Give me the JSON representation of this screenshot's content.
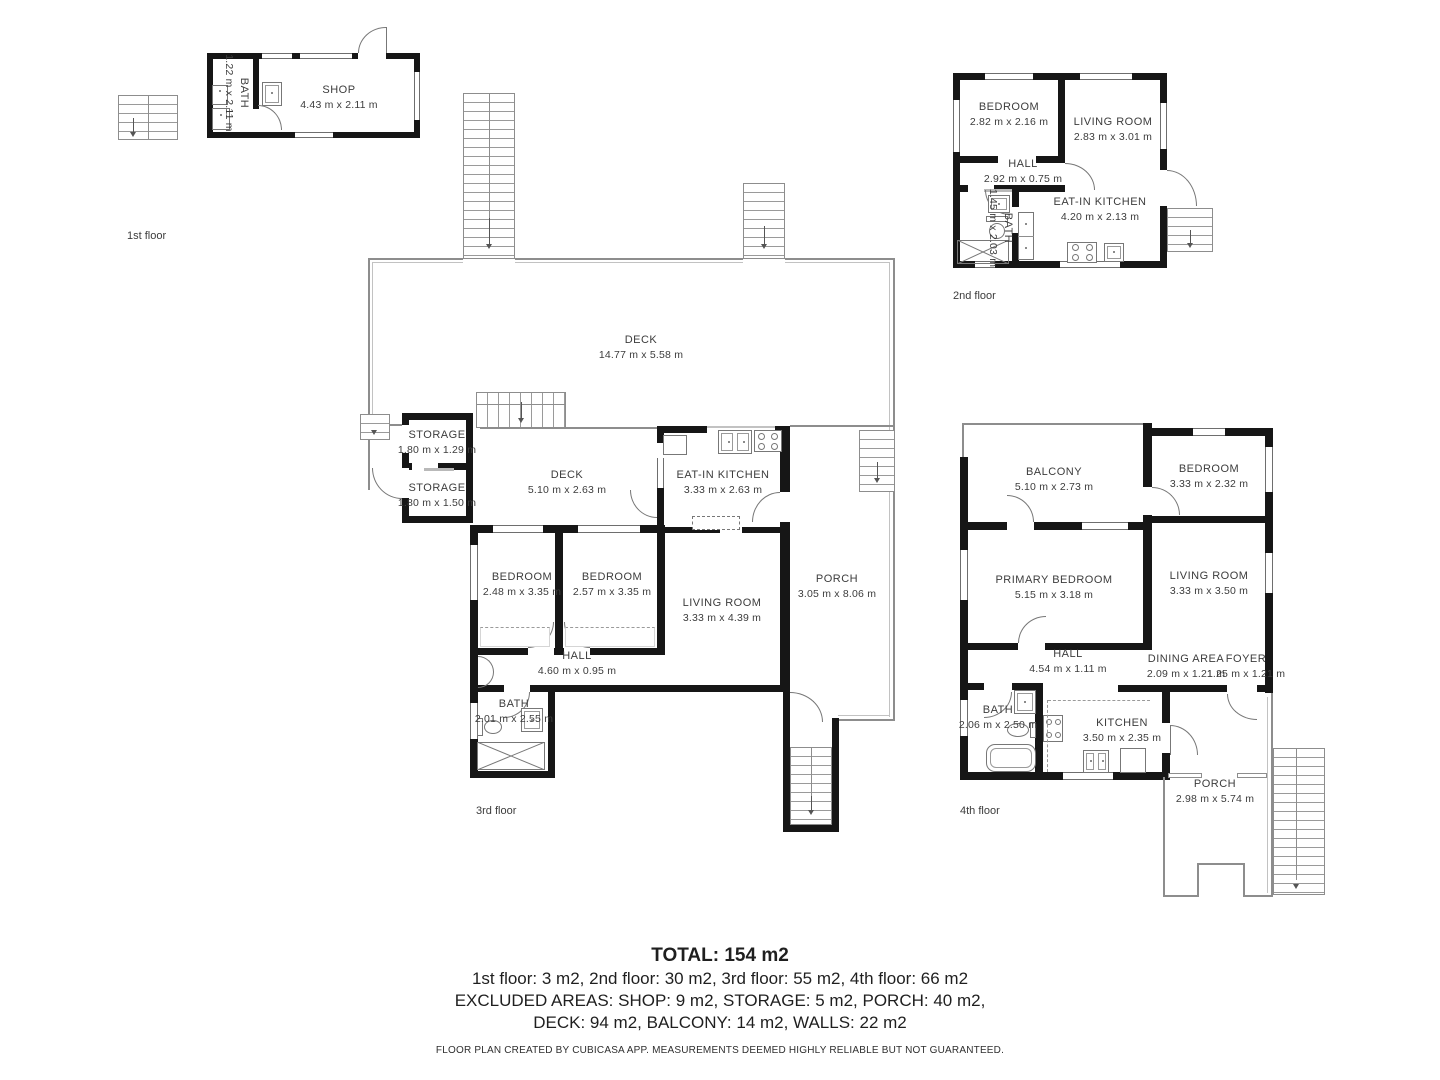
{
  "floors": {
    "f1": {
      "label": "1st floor",
      "rooms": {
        "bath": {
          "name": "BATH",
          "dims": "1.22 m x 2.11 m"
        },
        "shop": {
          "name": "SHOP",
          "dims": "4.43 m x 2.11 m"
        }
      }
    },
    "f2": {
      "label": "2nd floor",
      "rooms": {
        "bedroom": {
          "name": "BEDROOM",
          "dims": "2.82 m x 2.16 m"
        },
        "living": {
          "name": "LIVING ROOM",
          "dims": "2.83 m x 3.01 m"
        },
        "hall": {
          "name": "HALL",
          "dims": "2.92 m x 0.75 m"
        },
        "bath": {
          "name": "BATH",
          "dims": "1.45 m x 2.03 m"
        },
        "kitchen": {
          "name": "EAT-IN KITCHEN",
          "dims": "4.20 m x 2.13 m"
        }
      }
    },
    "f3": {
      "label": "3rd floor",
      "rooms": {
        "deck_large": {
          "name": "DECK",
          "dims": "14.77 m x 5.58 m"
        },
        "storage1": {
          "name": "STORAGE",
          "dims": "1.80 m x 1.29 m"
        },
        "storage2": {
          "name": "STORAGE",
          "dims": "1.80 m x 1.50 m"
        },
        "deck": {
          "name": "DECK",
          "dims": "5.10 m x 2.63 m"
        },
        "kitchen": {
          "name": "EAT-IN KITCHEN",
          "dims": "3.33 m x 2.63 m"
        },
        "bedroom1": {
          "name": "BEDROOM",
          "dims": "2.48 m x 3.35 m"
        },
        "bedroom2": {
          "name": "BEDROOM",
          "dims": "2.57 m x 3.35 m"
        },
        "living": {
          "name": "LIVING ROOM",
          "dims": "3.33 m x 4.39 m"
        },
        "porch": {
          "name": "PORCH",
          "dims": "3.05 m x 8.06 m"
        },
        "hall": {
          "name": "HALL",
          "dims": "4.60 m x 0.95 m"
        },
        "bath": {
          "name": "BATH",
          "dims": "2.01 m x 2.55 m"
        }
      }
    },
    "f4": {
      "label": "4th floor",
      "rooms": {
        "balcony": {
          "name": "BALCONY",
          "dims": "5.10 m x 2.73 m"
        },
        "bedroom": {
          "name": "BEDROOM",
          "dims": "3.33 m x 2.32 m"
        },
        "primary": {
          "name": "PRIMARY BEDROOM",
          "dims": "5.15 m x 3.18 m"
        },
        "living": {
          "name": "LIVING ROOM",
          "dims": "3.33 m x 3.50 m"
        },
        "hall": {
          "name": "HALL",
          "dims": "4.54 m x 1.11 m"
        },
        "dining": {
          "name": "DINING AREA",
          "dims": "2.09 m x 1.21 m"
        },
        "foyer": {
          "name": "FOYER",
          "dims": "1.25 m x 1.21 m"
        },
        "bath": {
          "name": "BATH",
          "dims": "2.06 m x 2.50 m"
        },
        "kitchen": {
          "name": "KITCHEN",
          "dims": "3.50 m x 2.35 m"
        },
        "porch": {
          "name": "PORCH",
          "dims": "2.98 m x 5.74 m"
        }
      }
    }
  },
  "summary": {
    "total": "TOTAL: 154 m2",
    "line1": "1st floor: 3 m2, 2nd floor: 30 m2, 3rd floor: 55 m2, 4th floor: 66 m2",
    "line2": "EXCLUDED AREAS: SHOP: 9 m2, STORAGE: 5 m2, PORCH: 40 m2,",
    "line3": "DECK: 94 m2, BALCONY: 14 m2, WALLS: 22 m2",
    "disclaimer": "FLOOR PLAN CREATED BY CUBICASA APP. MEASUREMENTS DEEMED HIGHLY RELIABLE BUT NOT GUARANTEED."
  },
  "colors": {
    "wall": "#161616",
    "line": "#8d8d8d",
    "text": "#3c3c3c"
  }
}
